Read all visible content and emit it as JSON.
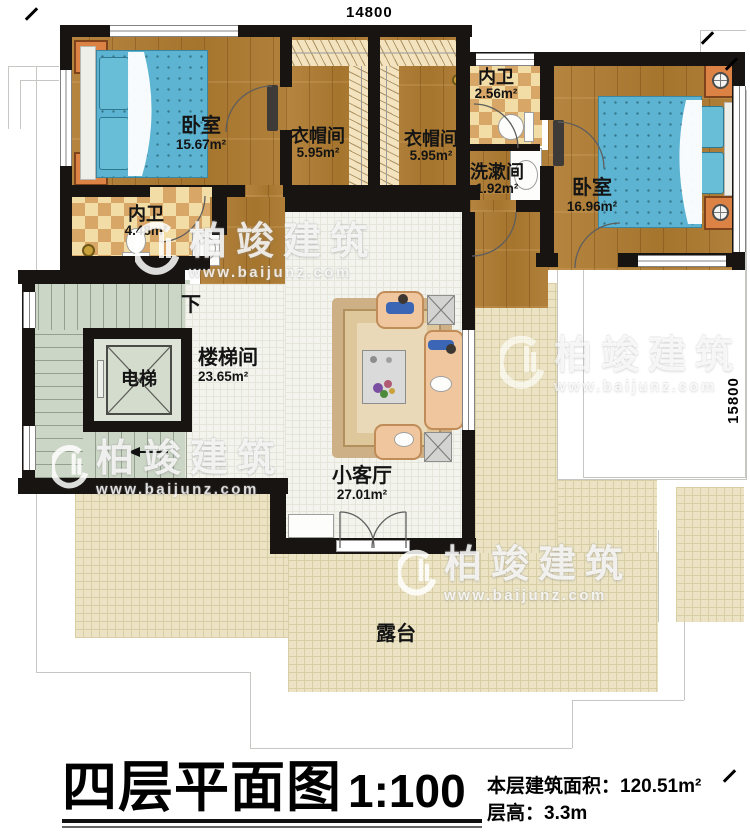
{
  "plan": {
    "dimensions": {
      "width_label": "14800",
      "height_label": "15800"
    },
    "rooms": [
      {
        "id": "bedroom-1",
        "name": "卧室",
        "area": "15.67m²"
      },
      {
        "id": "closet-1",
        "name": "衣帽间",
        "area": "5.95m²"
      },
      {
        "id": "closet-2",
        "name": "衣帽间",
        "area": "5.95m²"
      },
      {
        "id": "bath-top",
        "name": "内卫",
        "area": "2.56m²"
      },
      {
        "id": "washroom",
        "name": "洗漱间",
        "area": "1.92m²"
      },
      {
        "id": "bedroom-2",
        "name": "卧室",
        "area": "16.96m²"
      },
      {
        "id": "bath-left",
        "name": "内卫",
        "area": "4.48m²"
      },
      {
        "id": "stairwell",
        "name": "楼梯间",
        "area": "23.65m²"
      },
      {
        "id": "elevator",
        "name": "电梯"
      },
      {
        "id": "living",
        "name": "小客厅",
        "area": "27.01m²"
      },
      {
        "id": "terrace",
        "name": "露台"
      }
    ],
    "stair_direction_label": "下"
  },
  "titleblock": {
    "title": "四层平面图",
    "scale": "1:100",
    "area_label": "本层建筑面积：",
    "area_value": "120.51m²",
    "floor_height_label": "层高：",
    "floor_height_value": "3.3m"
  },
  "watermark": {
    "name": "柏竣建筑",
    "url": "www.baijunz.com"
  }
}
